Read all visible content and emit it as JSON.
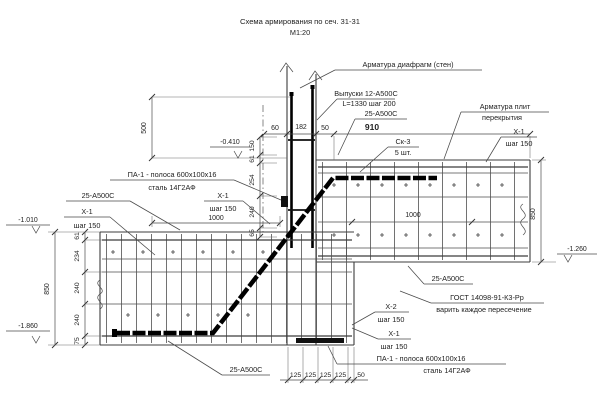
{
  "title": {
    "line1": "Схема армирования по сеч. 31-31",
    "line2": "М1:20"
  },
  "callouts": {
    "diaphragm_reinforcement": {
      "line1": "Арматура диафрагм (стен)"
    },
    "wall_outlets": {
      "line1": "Выпуски 12-А500С",
      "line2": "L=1330 шаг 200"
    },
    "bar25_top": {
      "line1": "25-А500С"
    },
    "sk3": {
      "line1": "Ск-3",
      "line2": "5 шт."
    },
    "slab_reinforcement": {
      "line1": "Арматура плит",
      "line2": "перекрытия"
    },
    "x1_right": {
      "line1": "Х-1",
      "line2": "шаг 150"
    },
    "pa1_upper": {
      "line1": "ПА-1 - полоса 600х100х16",
      "line2": "сталь 14Г2АФ"
    },
    "bar25_left": {
      "line1": "25-А500С"
    },
    "x1_left": {
      "line1": "Х-1",
      "line2": "шаг 150"
    },
    "x1_mid": {
      "line1": "Х-1",
      "line2": "шаг 150"
    },
    "bar25_right": {
      "line1": "25-А500С"
    },
    "gost_weld": {
      "line1": "ГОСТ 14098-91-К3-Рр",
      "line2": "варить каждое пересечение"
    },
    "x2_bottom": {
      "line1": "Х-2",
      "line2": "шаг 150"
    },
    "x1_bottom": {
      "line1": "Х-1",
      "line2": "шаг 150"
    },
    "pa1_lower": {
      "line1": "ПА-1 - полоса 600х100х16",
      "line2": "сталь 14Г2АФ"
    },
    "bar25_bottom": {
      "line1": "25-А500С"
    }
  },
  "elevations": {
    "upper": "-0.410",
    "left_top": "-1.010",
    "left_bottom": "-1.860",
    "right_bottom": "-1.260"
  },
  "dimensions": {
    "wall_top": [
      "60",
      "182",
      "50"
    ],
    "slab_span_right": "910",
    "outlet_height": "500",
    "left_anchor_length": "1000",
    "right_anchor_length": "1000",
    "left_total_height": "850",
    "left_segments": [
      "61",
      "234",
      "240",
      "240",
      "75"
    ],
    "right_total_height": "850",
    "center_segments": [
      "150",
      "61",
      "254",
      "240",
      "65"
    ],
    "bottom_spacings": [
      "125",
      "125",
      "125",
      "125"
    ],
    "bottom_edge_offset": "50"
  },
  "colors": {
    "background": "#ffffff",
    "line": "#3c3c3c",
    "mesh": "#555555",
    "rebar": "#000000",
    "text": "#222222"
  }
}
